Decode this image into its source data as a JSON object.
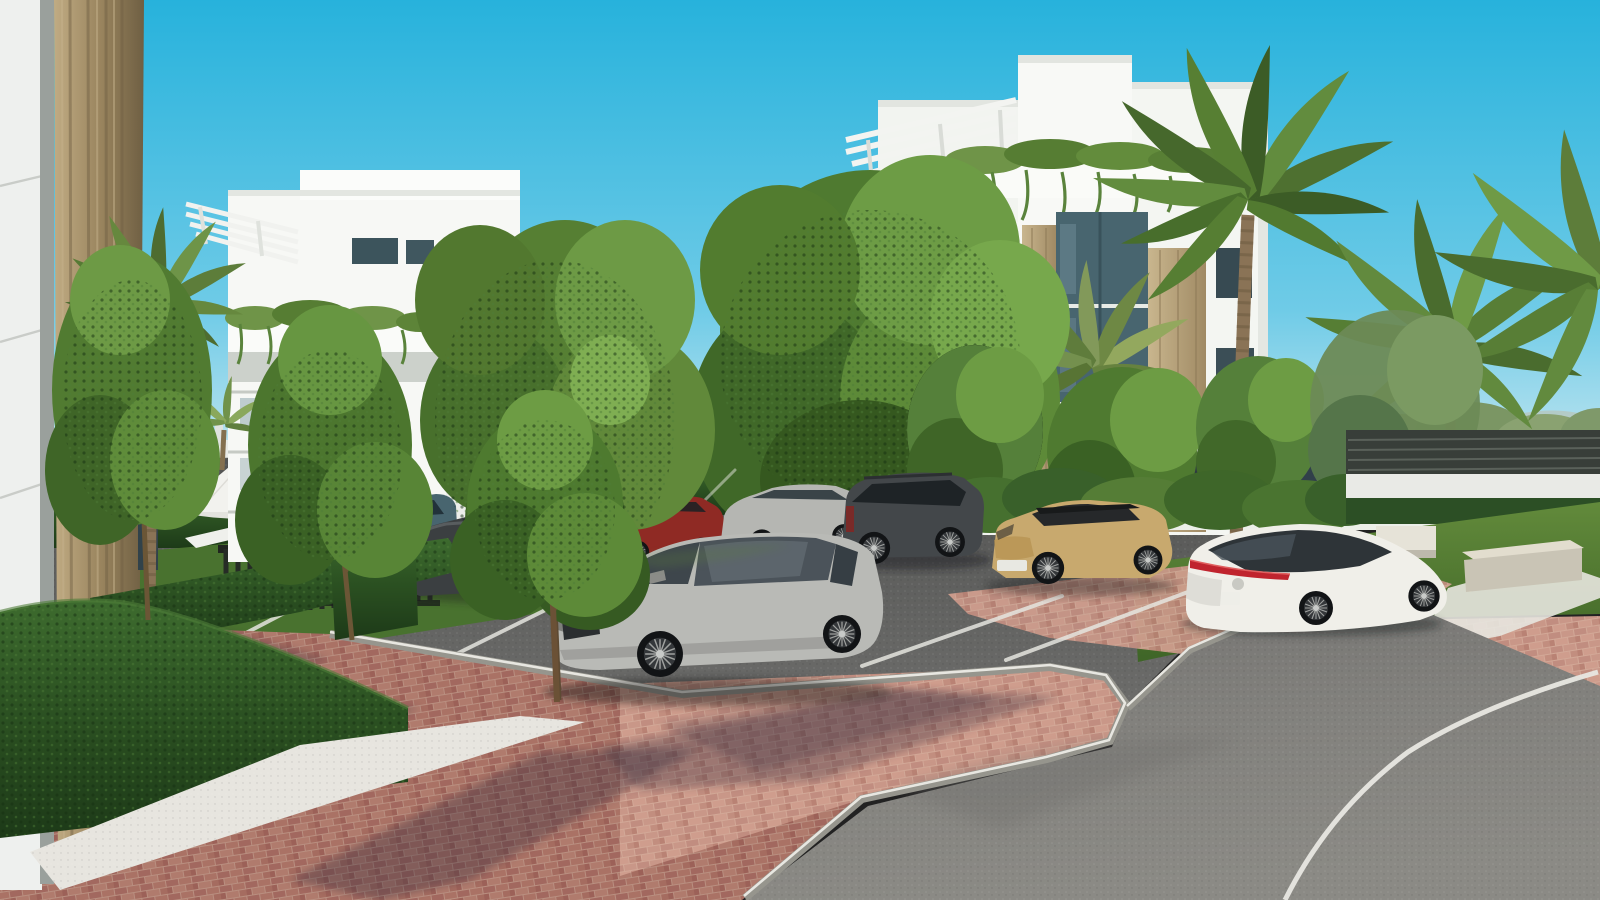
{
  "scene": {
    "type": "3d-architectural-render",
    "description": "New-build white apartment complex with palm trees, hedges, parking lot with cars and a curved asphalt road on a sunny day",
    "time_of_day": "daytime-sunny",
    "sky": {
      "top": "#27b2dc",
      "mid": "#6fcbe7",
      "horizon": "#d6ecf2"
    },
    "palette": {
      "building_white": "#f7f8f5",
      "building_shade": "#e8ebe6",
      "building_deep": "#d7dbd5",
      "stone_tan": "#b29a72",
      "stone_tan_dark": "#8b7854",
      "column_tan": "#97825c",
      "glass_dark": "#31434b",
      "glass_teal": "#48656f",
      "fence_dark": "#383e39",
      "wall_white": "#e9eae6",
      "hedge_dark": "#24431e",
      "hedge_mid": "#35612a",
      "tree_bright": "#6d9c44",
      "tree_mid": "#4f7a30",
      "tree_dark": "#395f24",
      "palm_green": "#5d7d3a",
      "palm_light": "#93a85e",
      "trunk_brown": "#8a7356",
      "lawn_green": "#4f7a31",
      "asphalt_parking": "#5e5f5e",
      "asphalt_road": "#807f7b",
      "brick_red": "#a2685f",
      "brick_pink": "#c18d80",
      "curb_grey": "#96958d",
      "line_white": "#e8e7e1",
      "gravel_white": "#e7e5df",
      "shadow_purple": "#342b3b",
      "bench_concrete": "#d8d3c4",
      "umbrella_white": "#f2f2ee",
      "tail_light_red": "#c0242e"
    },
    "vehicles": [
      {
        "name": "silver-mercedes-suv",
        "color": "#b9bab6",
        "position": "foreground parking bay, facing lower-left"
      },
      {
        "name": "white-mercedes-eqs",
        "color": "#f0efe9",
        "position": "right parking bay, rear three-quarter view"
      },
      {
        "name": "tan-toyota-yaris-cross",
        "color": "#c8a96e",
        "position": "right of center, black roof"
      },
      {
        "name": "dark-grey-santa-fe-suv",
        "color": "#43474a",
        "position": "middle row"
      },
      {
        "name": "silver-sedan",
        "color": "#b5b6b2",
        "position": "middle row"
      },
      {
        "name": "red-hatchback",
        "color": "#8f2a24",
        "position": "middle row"
      },
      {
        "name": "dark-grey-sedan",
        "color": "#3b3f41",
        "position": "left row behind trees"
      },
      {
        "name": "teal-suv",
        "color": "#41606b",
        "position": "left row behind trees"
      },
      {
        "name": "distant-moving-silver-car",
        "color": "#c0c2bf",
        "position": "background road behind fence"
      }
    ],
    "buildings": [
      {
        "name": "left-apartment-block",
        "floors": 4,
        "features": "roof pergola, trailing balcony plants, tan stone band"
      },
      {
        "name": "right-apartment-block",
        "floors": 4,
        "features": "stepped roofline, pergolas, hanging balcony greenery, tan stone columns, glass strip"
      },
      {
        "name": "foreground-building-edge",
        "features": "white panel wall and tan rammed-earth column at extreme left"
      }
    ],
    "landscape": [
      "fan palms",
      "feather palms",
      "young deciduous trees",
      "trimmed boxwood hedges",
      "lawn with small yellow flowers",
      "white gravel strip",
      "red brick paving",
      "distant town and mountains"
    ],
    "street_furniture": [
      "white parasol",
      "white sun loungers",
      "dark slatted gate",
      "concrete benches",
      "horizontal-slat perimeter fence on white wall",
      "construction cranes in distance"
    ]
  }
}
